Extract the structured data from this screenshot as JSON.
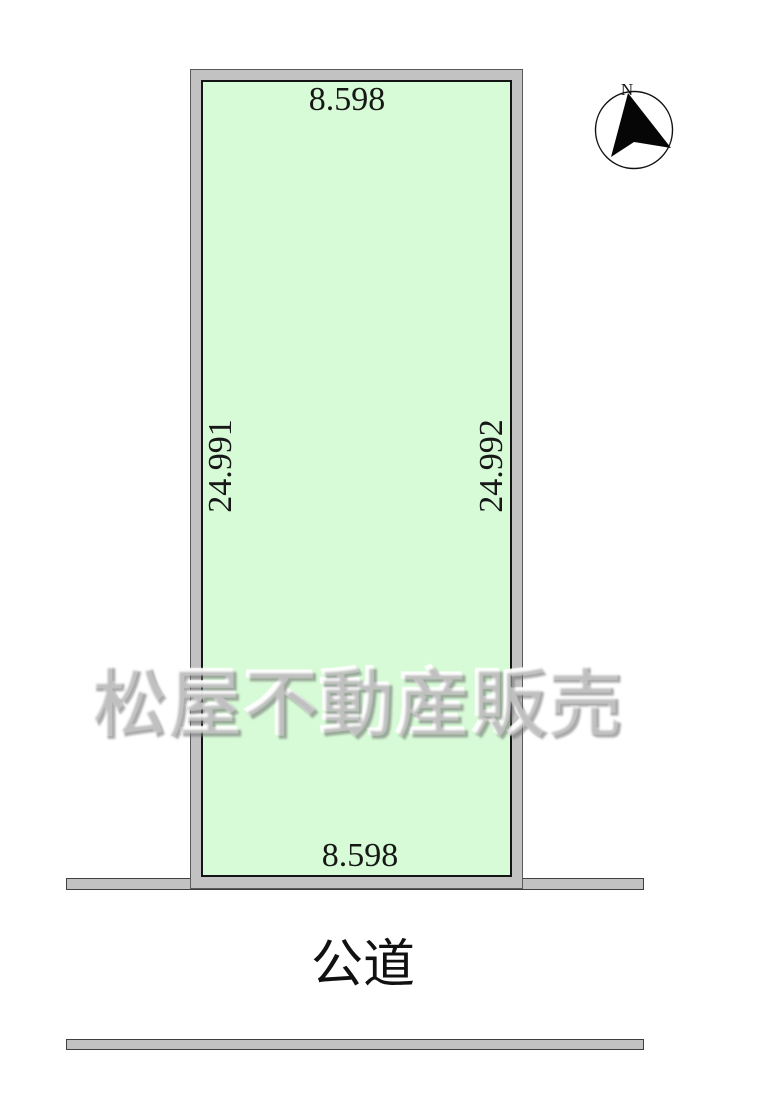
{
  "colors": {
    "plot_fill": "#d6fbd6",
    "boundary_gray": "#c2c2c2",
    "line_black": "#141414",
    "text": "#171717"
  },
  "plot": {
    "dim_top": "8.598",
    "dim_bottom": "8.598",
    "dim_left": "24.991",
    "dim_right": "24.992"
  },
  "road": {
    "label": "公道"
  },
  "compass": {
    "north_label": "N"
  },
  "watermark": {
    "text": "松屋不動産販売"
  }
}
